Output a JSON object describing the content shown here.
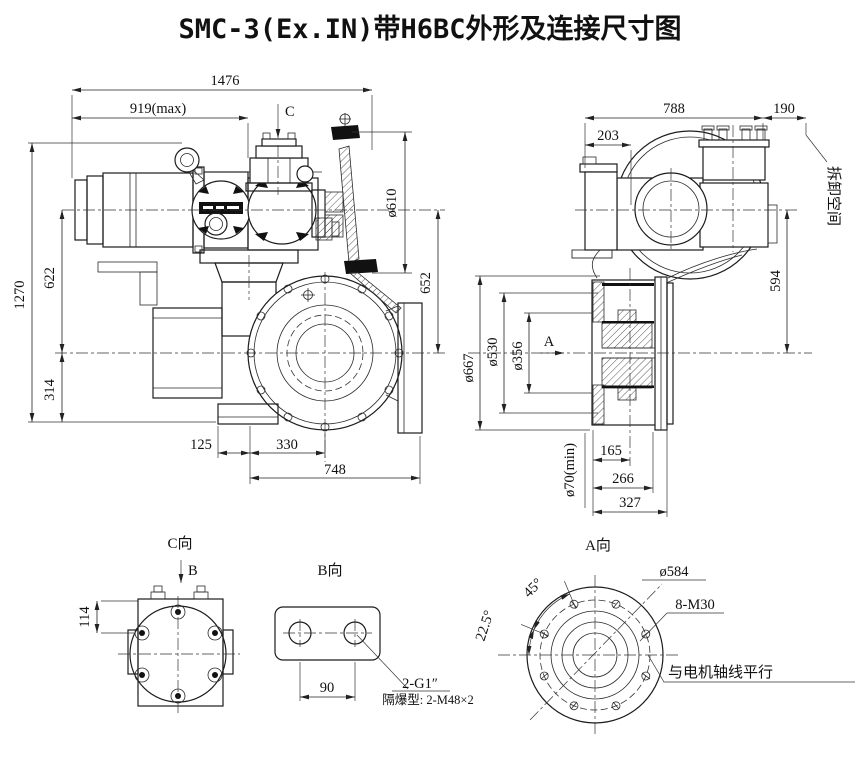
{
  "title": "SMC-3(Ex.IN)带H6BC外形及连接尺寸图",
  "colors": {
    "background": "#ffffff",
    "line": "#1c1c1c"
  },
  "side_view": {
    "dim_1476": "1476",
    "dim_919": "919(max)",
    "marker_c": "C",
    "dia_610": "ø610",
    "dim_652": "652",
    "dim_1270": "1270",
    "dim_622": "622",
    "dim_314": "314",
    "dim_125": "125",
    "dim_330": "330",
    "dim_748": "748"
  },
  "end_view": {
    "dim_788": "788",
    "dim_190": "190",
    "dim_203": "203",
    "note_removal_space": "拆卸空间",
    "dim_594": "594",
    "dia_667": "ø667",
    "dia_530": "ø530",
    "dia_356": "ø356",
    "marker_a": "A",
    "dia_70": "ø70(min)",
    "dim_165": "165",
    "dim_266": "266",
    "dim_327": "327"
  },
  "view_c": {
    "title": "C向",
    "marker_b": "B",
    "dim_114": "114"
  },
  "view_b": {
    "title": "B向",
    "dim_90": "90",
    "callout_g1": "2-G1″",
    "callout_flameproof": "隔爆型: 2-M48×2"
  },
  "view_a": {
    "title": "A向",
    "dim_45": "45°",
    "dim_22_5": "22.5°",
    "dia_584": "ø584",
    "callout_8m30": "8-M30",
    "note_parallel": "与电机轴线平行"
  }
}
